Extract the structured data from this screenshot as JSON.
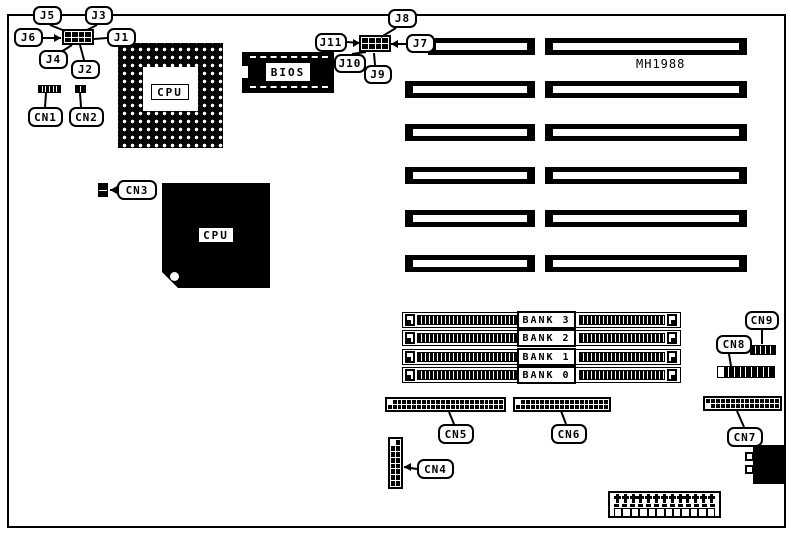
{
  "diagram": {
    "model_text": "MH1988",
    "pga_socket_label": "CPU",
    "cpu_chip_label": "CPU",
    "bios_label": "BIOS"
  },
  "jumpers": [
    {
      "id": "J1",
      "label": "J1"
    },
    {
      "id": "J2",
      "label": "J2"
    },
    {
      "id": "J3",
      "label": "J3"
    },
    {
      "id": "J4",
      "label": "J4"
    },
    {
      "id": "J5",
      "label": "J5"
    },
    {
      "id": "J6",
      "label": "J6"
    },
    {
      "id": "J7",
      "label": "J7"
    },
    {
      "id": "J8",
      "label": "J8"
    },
    {
      "id": "J9",
      "label": "J9"
    },
    {
      "id": "J10",
      "label": "J10"
    },
    {
      "id": "J11",
      "label": "J11"
    }
  ],
  "connectors": [
    {
      "id": "CN1",
      "label": "CN1",
      "pins": {
        "rows": 1,
        "cols": 6
      }
    },
    {
      "id": "CN2",
      "label": "CN2",
      "pins": {
        "rows": 1,
        "cols": 2
      }
    },
    {
      "id": "CN3",
      "label": "CN3",
      "pins": {
        "rows": 2,
        "cols": 1
      }
    },
    {
      "id": "CN4",
      "label": "CN4",
      "pins": {
        "rows": 8,
        "cols": 2
      }
    },
    {
      "id": "CN5",
      "label": "CN5",
      "pins": {
        "rows": 2,
        "cols": 24
      }
    },
    {
      "id": "CN6",
      "label": "CN6",
      "pins": {
        "rows": 2,
        "cols": 19
      }
    },
    {
      "id": "CN7",
      "label": "CN7",
      "pins": {
        "rows": 2,
        "cols": 15
      }
    },
    {
      "id": "CN8",
      "label": "CN8",
      "pins": {
        "rows": 1,
        "cols": 10
      }
    },
    {
      "id": "CN9",
      "label": "CN9",
      "pins": {
        "rows": 1,
        "cols": 5
      }
    }
  ],
  "memory_banks": [
    {
      "label": "BANK 3"
    },
    {
      "label": "BANK 2"
    },
    {
      "label": "BANK 1"
    },
    {
      "label": "BANK 0"
    }
  ],
  "expansion_slots": {
    "rows": 6,
    "segments_per_row": 2
  },
  "power_connector": {
    "top_pins": 13,
    "bottom_sockets": 12
  },
  "colors": {
    "ink": "#000000",
    "paper": "#ffffff"
  }
}
